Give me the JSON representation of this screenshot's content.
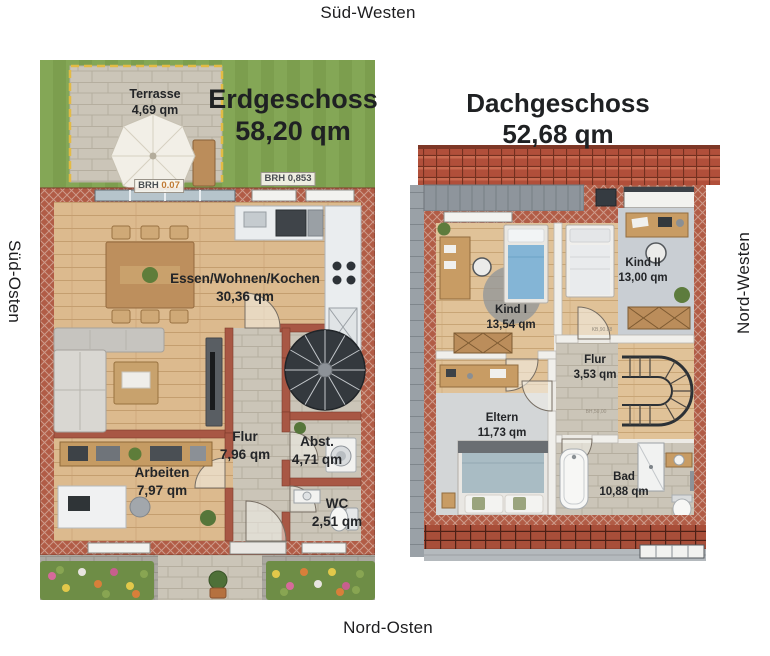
{
  "orientation": {
    "top": "Süd-Westen",
    "left": "Süd-Osten",
    "right": "Nord-Westen",
    "bottom": "Nord-Osten"
  },
  "erdgeschoss": {
    "title": "Erdgeschoss",
    "area": "58,20 qm",
    "rooms": {
      "terrasse": {
        "name": "Terrasse",
        "area": "4,69 qm"
      },
      "wohnen": {
        "name": "Essen/Wohnen/Kochen",
        "area": "30,36 qm"
      },
      "flur": {
        "name": "Flur",
        "area": "7,96 qm"
      },
      "abst": {
        "name": "Abst.",
        "area": "4,71 qm"
      },
      "arbeiten": {
        "name": "Arbeiten",
        "area": "7,97 qm"
      },
      "wc": {
        "name": "WC",
        "area": "2,51 qm"
      }
    },
    "annotations": {
      "brh1_label": "BRH",
      "brh1_value": "0.07",
      "brh2_label": "BRH",
      "brh2_value": "0,853"
    }
  },
  "dachgeschoss": {
    "title": "Dachgeschoss",
    "area": "52,68 qm",
    "rooms": {
      "kind1": {
        "name": "Kind I",
        "area": "13,54 qm"
      },
      "kind2": {
        "name": "Kind II",
        "area": "13,00 qm"
      },
      "flur": {
        "name": "Flur",
        "area": "3,53 qm"
      },
      "eltern": {
        "name": "Eltern",
        "area": "11,73 qm"
      },
      "bad": {
        "name": "Bad",
        "area": "10,88 qm"
      }
    },
    "annotations": {
      "door1": "KB,90.88",
      "door2": "BH,50,00"
    }
  },
  "colors": {
    "grass": "#7c9e4e",
    "brick_wall": "#b15c46",
    "wood_floor": "#dcba8e",
    "stone_floor": "#cbc5b8",
    "roof_tile": "#b14f3a",
    "terrace_border": "#e3bb45",
    "label_text": "#232528"
  }
}
